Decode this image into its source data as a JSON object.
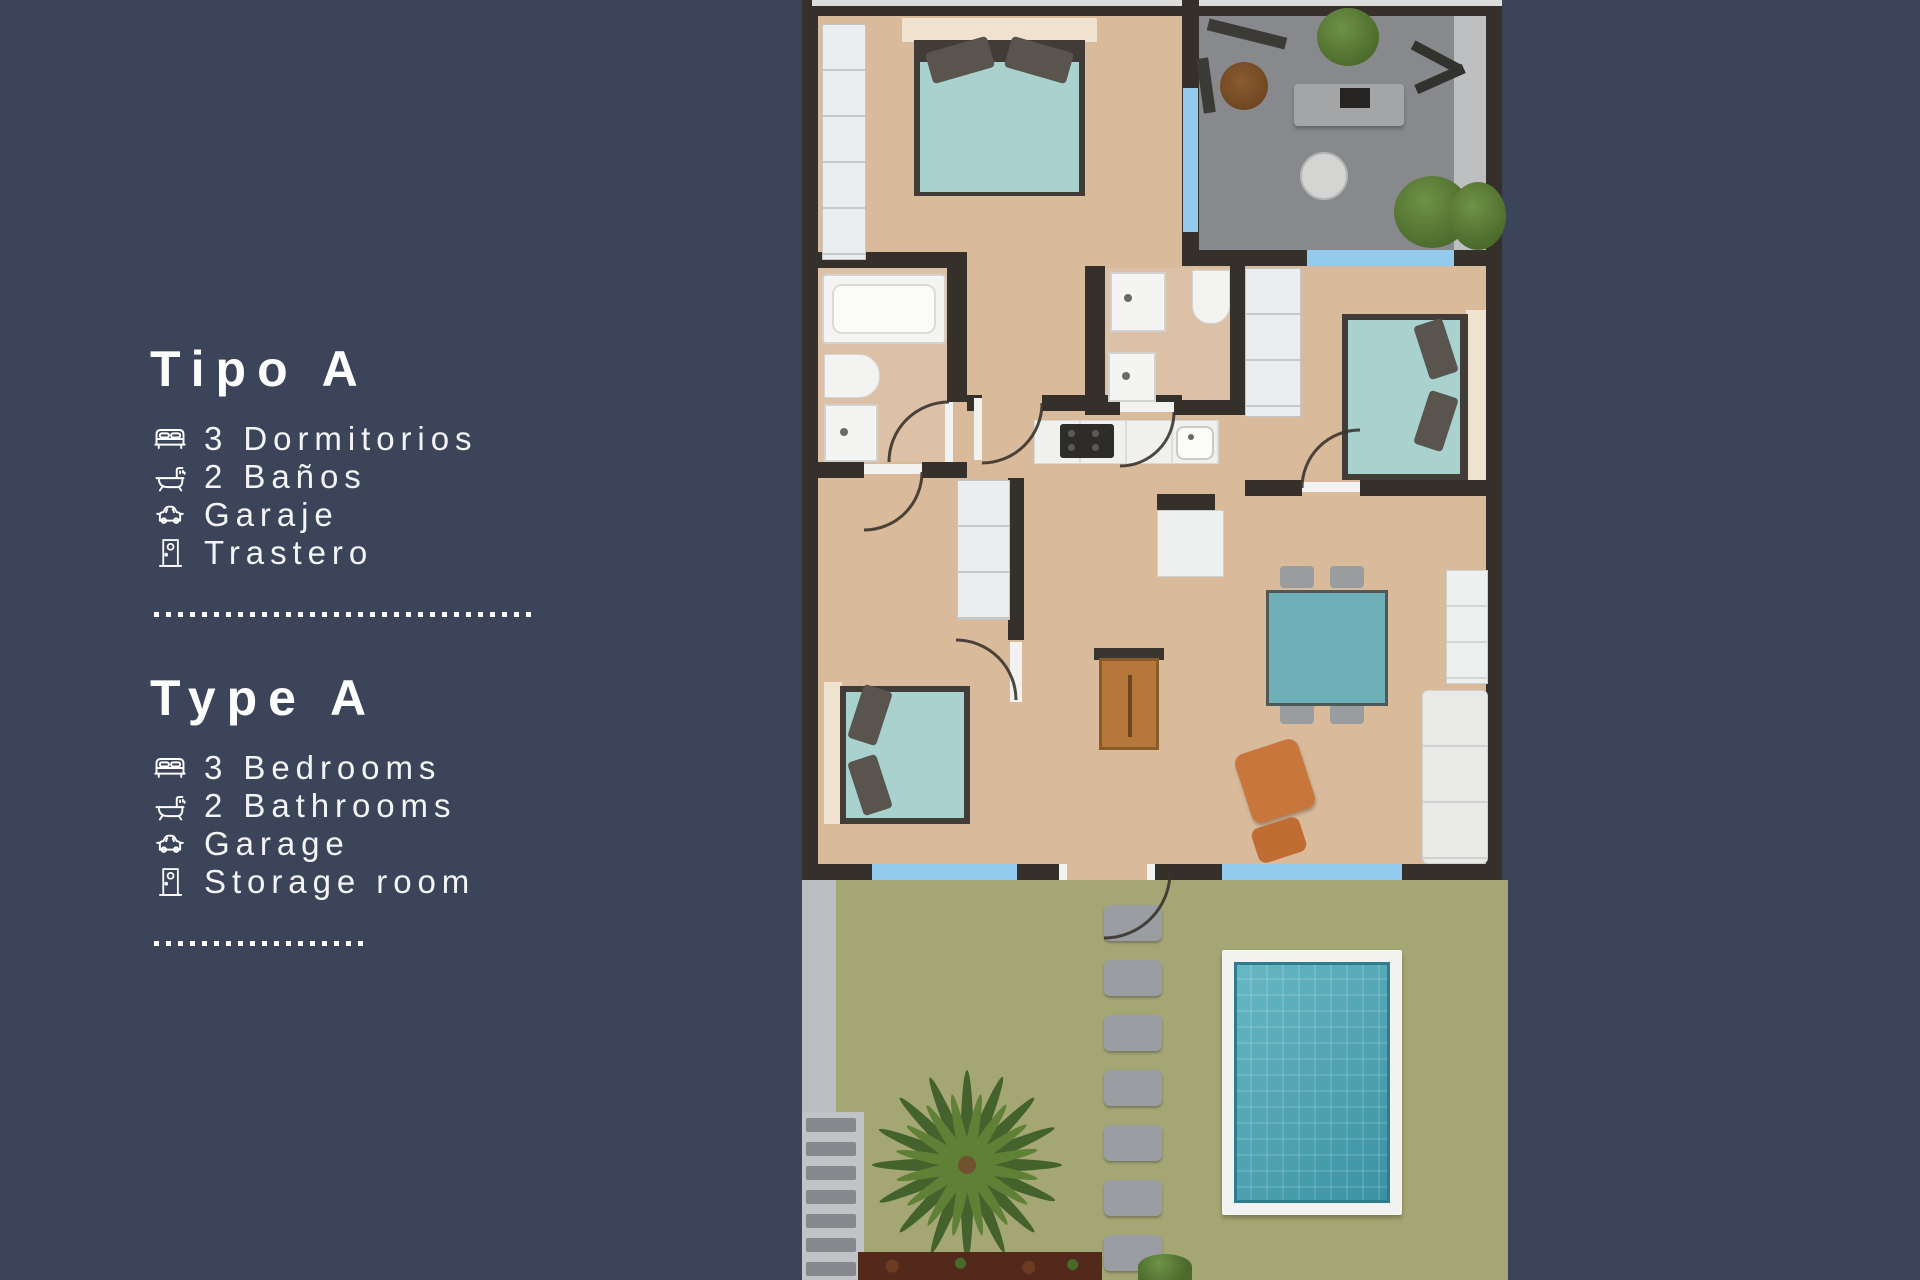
{
  "panel": {
    "sections": [
      {
        "title": "Tipo A",
        "items": [
          {
            "icon": "bed-icon",
            "label": "3 Dormitorios"
          },
          {
            "icon": "bath-icon",
            "label": "2 Baños"
          },
          {
            "icon": "car-icon",
            "label": "Garaje"
          },
          {
            "icon": "door-icon",
            "label": "Trastero"
          }
        ]
      },
      {
        "title": "Type A",
        "items": [
          {
            "icon": "bed-icon",
            "label": "3 Bedrooms"
          },
          {
            "icon": "bath-icon",
            "label": "2 Bathrooms"
          },
          {
            "icon": "car-icon",
            "label": "Garage"
          },
          {
            "icon": "door-icon",
            "label": "Storage room"
          }
        ]
      }
    ]
  },
  "colors": {
    "background": "#3b4458",
    "text": "#ffffff",
    "wall": "#353029",
    "floor_tan": "#d9bb9b",
    "terrace_gray": "#87898d",
    "window_blue": "#93cbee",
    "bed_teal": "#a9d2cf",
    "pool_teal": "#47a8b8",
    "garden_green": "#a4a773",
    "entry_door_brown": "#b5773a",
    "armchair_orange": "#c8763c"
  }
}
